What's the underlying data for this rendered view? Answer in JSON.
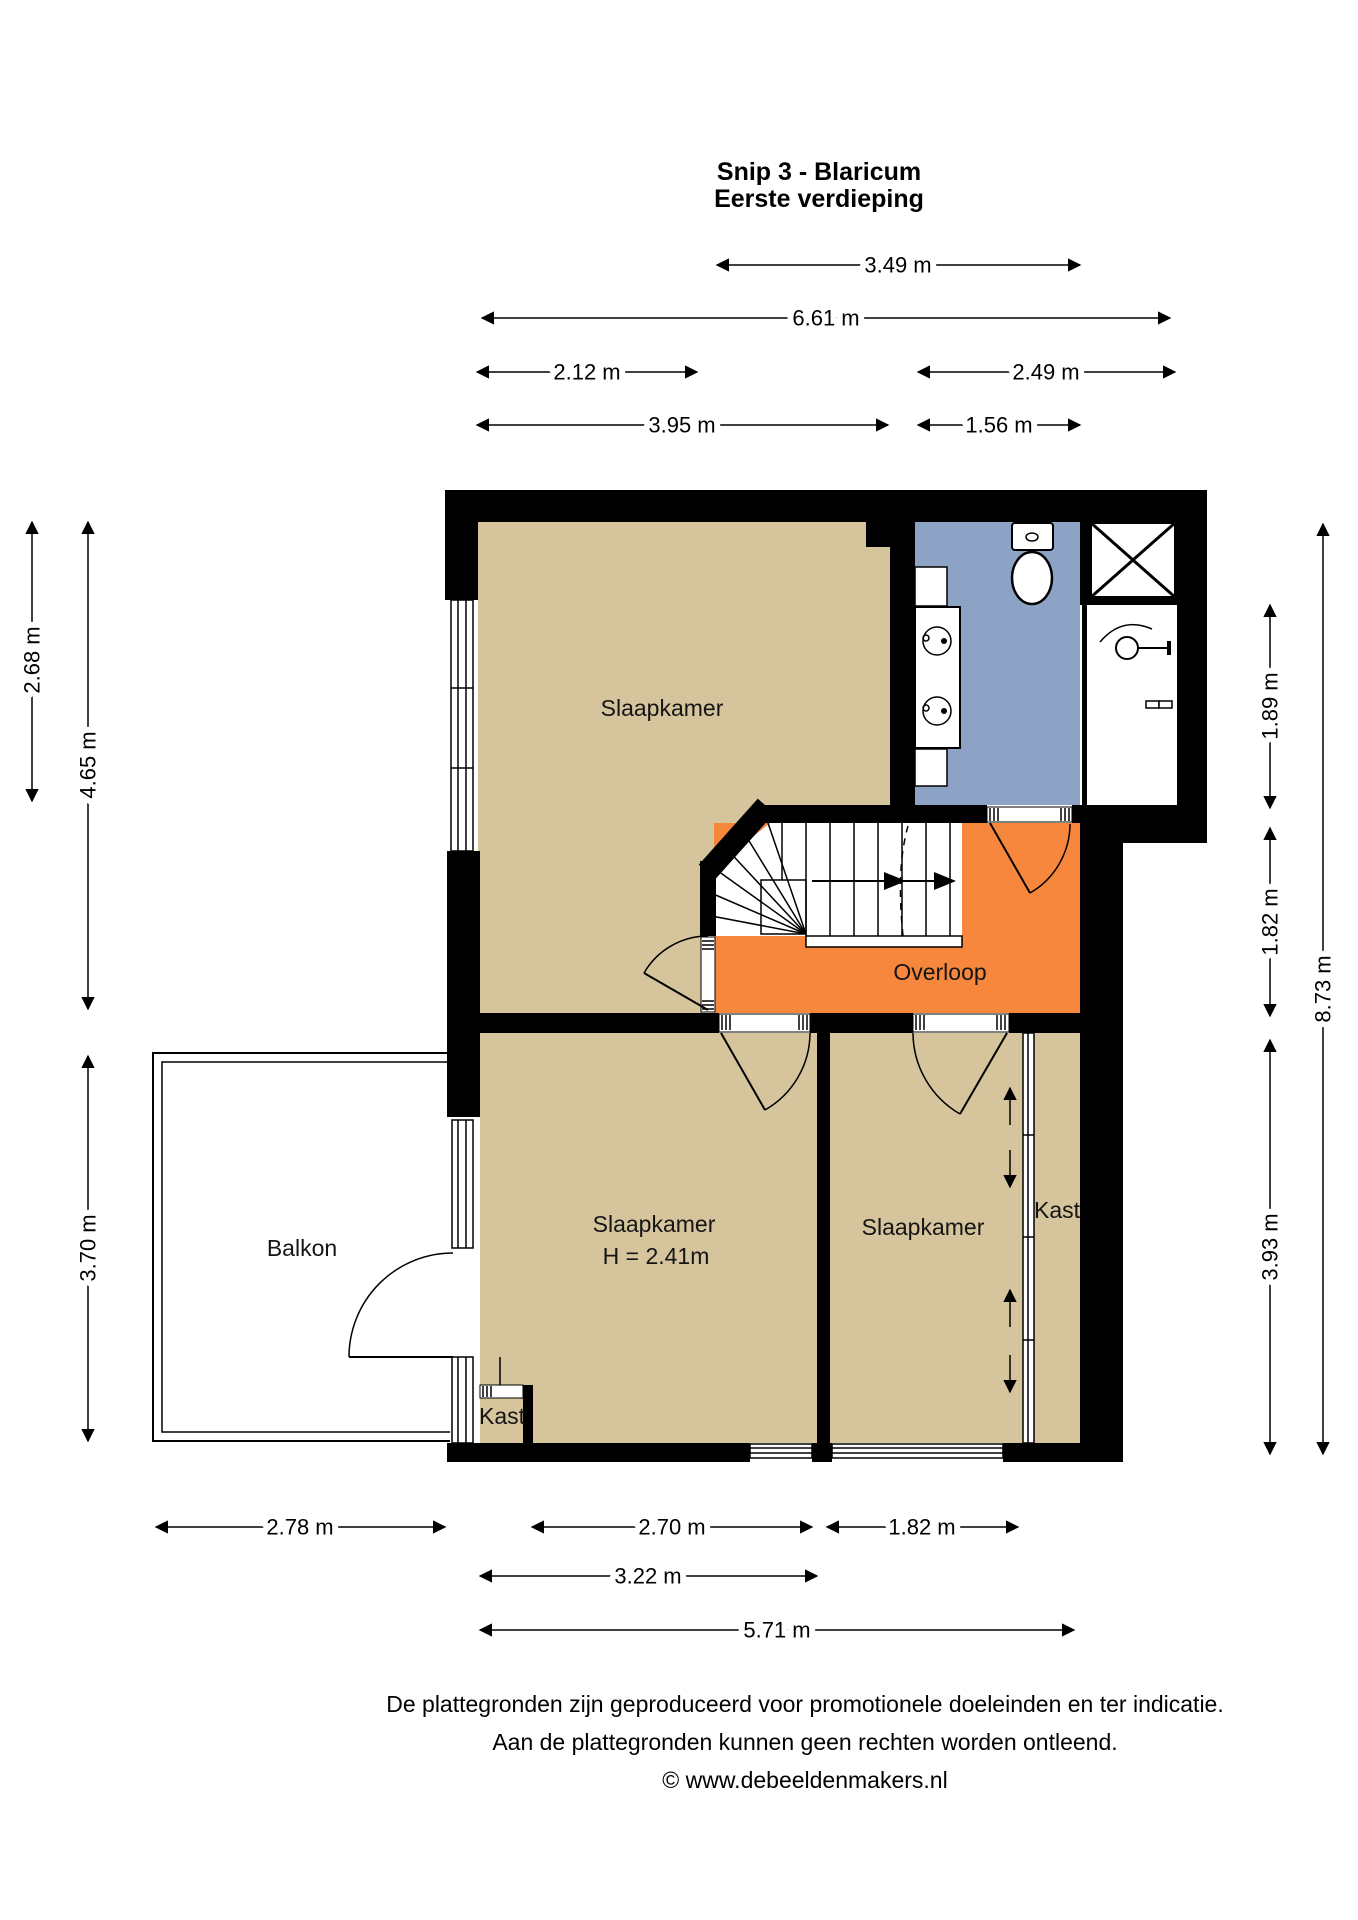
{
  "title": {
    "line1": "Snip 3 - Blaricum",
    "line2": "Eerste verdieping"
  },
  "rooms": {
    "bedroom_top": "Slaapkamer",
    "bedroom_mid": "Slaapkamer",
    "bedroom_mid_height": "H = 2.41m",
    "bedroom_right": "Slaapkamer",
    "hall": "Overloop",
    "balcony": "Balkon",
    "closet_left": "Kast",
    "closet_right": "Kast"
  },
  "dims": {
    "w349": "3.49 m",
    "w661": "6.61 m",
    "w212": "2.12 m",
    "w249": "2.49 m",
    "w395": "3.95 m",
    "w156": "1.56 m",
    "h268": "2.68 m",
    "h465": "4.65 m",
    "h370": "3.70 m",
    "h189": "1.89 m",
    "h182": "1.82 m",
    "h873": "8.73 m",
    "h393": "3.93 m",
    "b278": "2.78 m",
    "b270": "2.70 m",
    "b182": "1.82 m",
    "b322": "3.22 m",
    "b571": "5.71 m"
  },
  "footer": {
    "line1": "De plattegronden zijn geproduceerd voor promotionele doeleinden en ter indicatie.",
    "line2": "Aan de plattegronden kunnen geen rechten worden ontleend.",
    "line3": "© www.debeeldenmakers.nl"
  },
  "colors": {
    "floor": "#D5C49C",
    "bathroom": "#8DA3C6",
    "hall": "#F6873D",
    "wall": "#000000"
  }
}
